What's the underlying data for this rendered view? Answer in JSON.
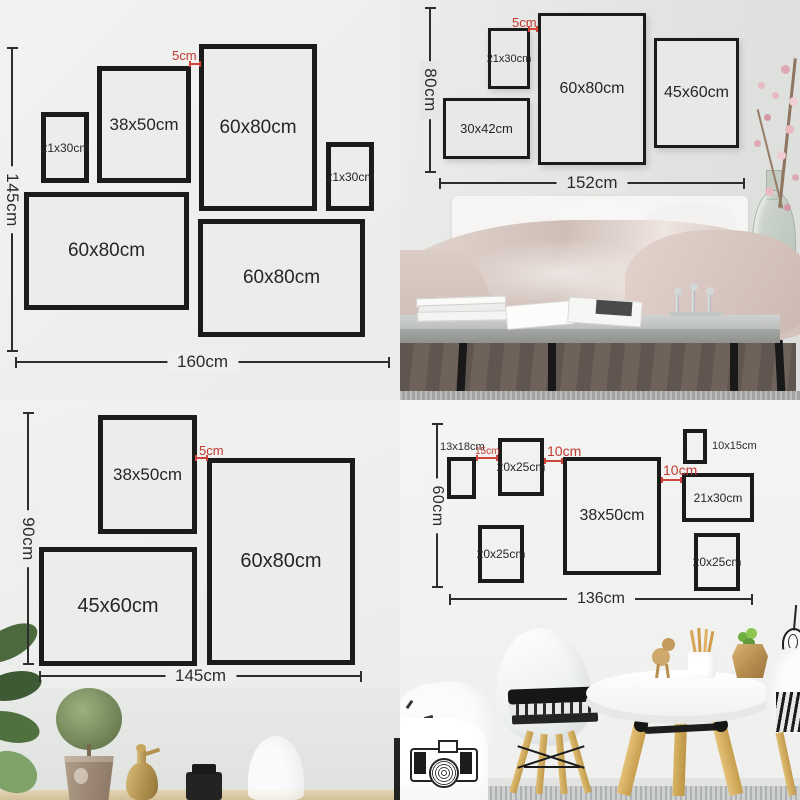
{
  "colors": {
    "accent_red": "#c13a31",
    "frame_border": "#1b1b1b",
    "ruler": "#2e2e2e"
  },
  "panels": {
    "top_left": {
      "height_total": "145cm",
      "width_total": "160cm",
      "gap": "5cm",
      "frames": [
        "21x30cm",
        "38x50cm",
        "60x80cm",
        "21x30cm",
        "60x80cm",
        "60x80cm"
      ]
    },
    "top_right": {
      "height_total": "80cm",
      "width_total": "152cm",
      "gap": "5cm",
      "frames": [
        "21x30cm",
        "60x80cm",
        "45x60cm",
        "30x42cm"
      ]
    },
    "bottom_left": {
      "height_total": "90cm",
      "width_total": "145cm",
      "gap": "5cm",
      "frames": [
        "38x50cm",
        "60x80cm",
        "45x60cm"
      ]
    },
    "bottom_right": {
      "height_total": "60cm",
      "width_total": "136cm",
      "gaps": [
        "15cm",
        "10cm",
        "10cm"
      ],
      "frames": [
        "13x18cm",
        "20x25cm",
        "38x50cm",
        "10x15cm",
        "21x30cm",
        "20x25cm",
        "20x25cm"
      ]
    }
  }
}
